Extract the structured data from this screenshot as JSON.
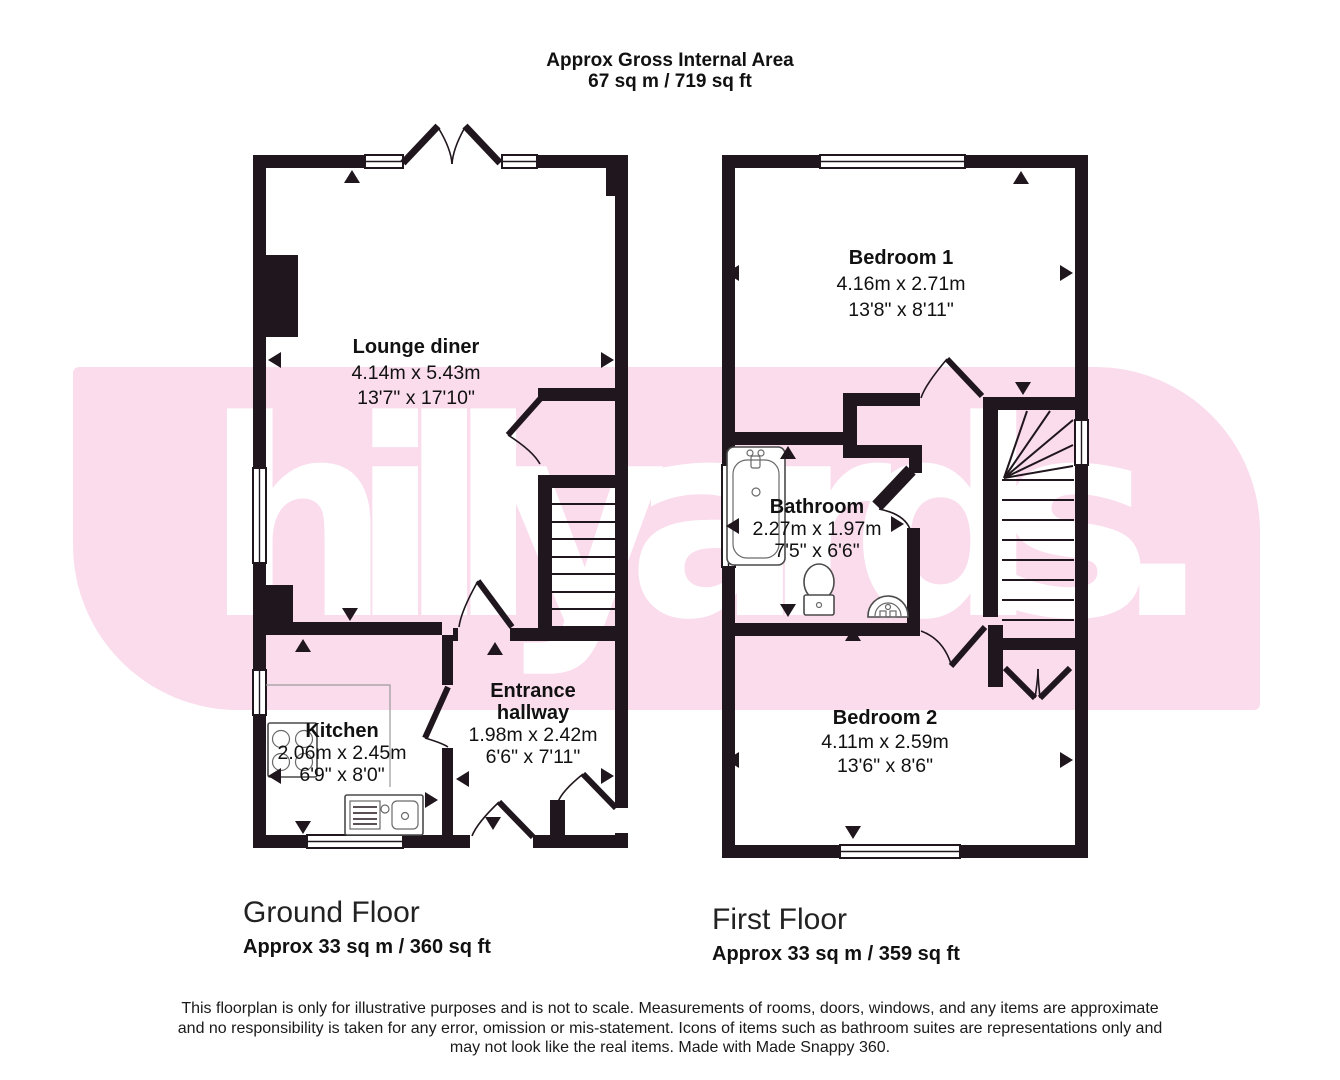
{
  "header": {
    "title": "Approx Gross Internal Area",
    "area": "67 sq m / 719 sq ft"
  },
  "watermark": {
    "text": "hillyards.",
    "band_color": "#fadcec",
    "text_color": "#ffffff"
  },
  "ground_floor": {
    "label": "Ground Floor",
    "area_label": "Approx 33 sq m / 360 sq ft",
    "rooms": {
      "lounge": {
        "name": "Lounge diner",
        "metric": "4.14m x 5.43m",
        "imperial": "13'7\" x 17'10\""
      },
      "kitchen": {
        "name": "Kitchen",
        "metric": "2.06m x 2.45m",
        "imperial": "6'9\" x 8'0\""
      },
      "hallway": {
        "name_line1": "Entrance",
        "name_line2": "hallway",
        "metric": "1.98m x 2.42m",
        "imperial": "6'6\" x 7'11\""
      }
    }
  },
  "first_floor": {
    "label": "First Floor",
    "area_label": "Approx 33 sq m / 359 sq ft",
    "rooms": {
      "bedroom1": {
        "name": "Bedroom 1",
        "metric": "4.16m x 2.71m",
        "imperial": "13'8\" x 8'11\""
      },
      "bathroom": {
        "name": "Bathroom",
        "metric": "2.27m x 1.97m",
        "imperial": "7'5\" x 6'6\""
      },
      "bedroom2": {
        "name": "Bedroom 2",
        "metric": "4.11m x 2.59m",
        "imperial": "13'6\" x 8'6\""
      }
    }
  },
  "disclaimer": {
    "line1": "This floorplan is only for illustrative purposes and is not to scale. Measurements of rooms, doors, windows, and any items are approximate",
    "line2": "and no responsibility is taken for any error, omission or mis-statement. Icons of items such as bathroom suites are representations only and",
    "line3": "may not look like the real items. Made with Made Snappy 360."
  },
  "colors": {
    "wall": "#20161d",
    "band": "#fadcec"
  }
}
